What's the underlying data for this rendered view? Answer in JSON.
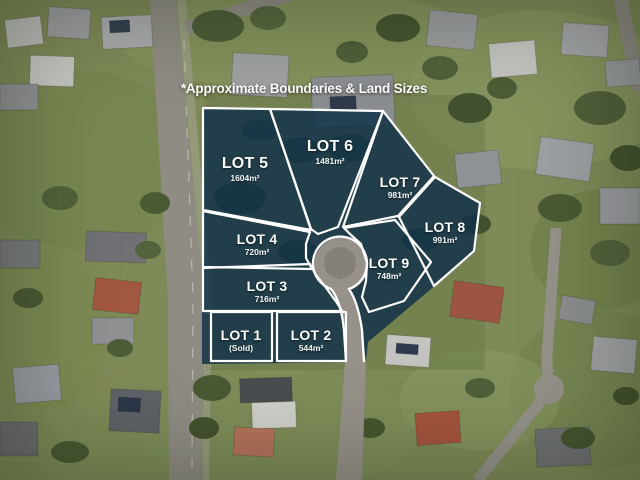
{
  "annotation": {
    "disclaimer": "*Approximate Boundaries & Land Sizes"
  },
  "lots": [
    {
      "name": "LOT 1",
      "area": "(Sold)"
    },
    {
      "name": "LOT 2",
      "area": "544m²"
    },
    {
      "name": "LOT 3",
      "area": "716m²"
    },
    {
      "name": "LOT 4",
      "area": "720m²"
    },
    {
      "name": "LOT 5",
      "area": "1604m²"
    },
    {
      "name": "LOT 6",
      "area": "1481m²"
    },
    {
      "name": "LOT 7",
      "area": "981m²"
    },
    {
      "name": "LOT 8",
      "area": "991m²"
    },
    {
      "name": "LOT 9",
      "area": "748m²"
    }
  ],
  "colors": {
    "overlay_fill": "#0f3049",
    "boundary_line": "#ffffff",
    "road_gray": "#96928a"
  }
}
